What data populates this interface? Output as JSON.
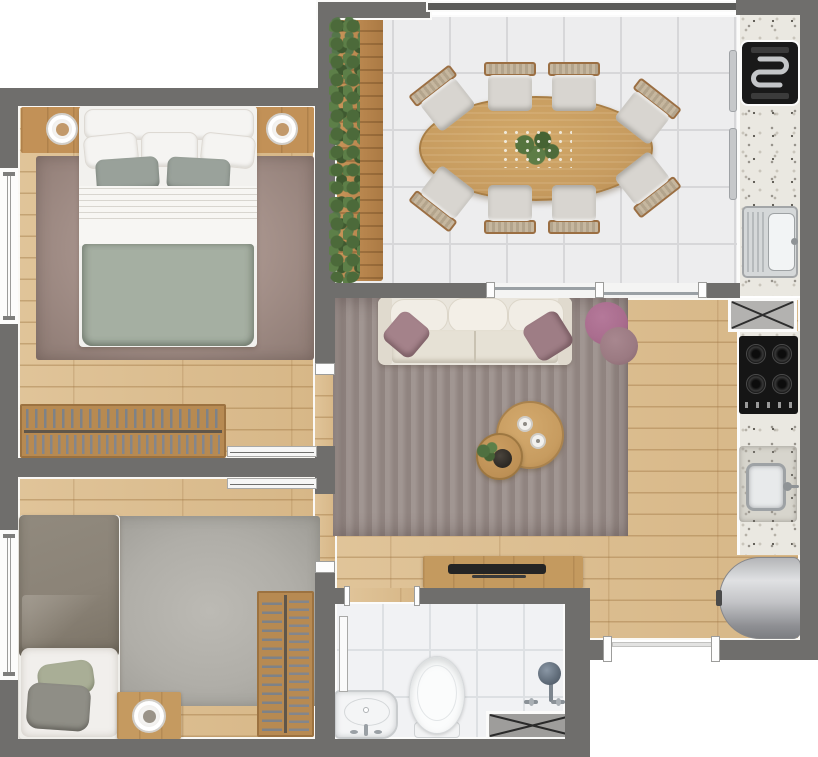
{
  "meta": {
    "type": "floor-plan",
    "render_style": "top-down 3D architectural render",
    "canvas": {
      "width": 818,
      "height": 757
    },
    "visible_text": "none"
  },
  "palette": {
    "wall": "#6f6e6c",
    "outline_white": "#fbfbfa",
    "wood_floor": "#ddc095",
    "plank_line": "#9c723e",
    "deck_wood": "#bd8a52",
    "tile_floor": "#ededee",
    "bathroom_tile": "#f1f2f4",
    "granite_counter": "#eae8e1",
    "rug_living": "#968a86",
    "rug_bedroom1": "#a5918a",
    "rug_bedroom2": "#b2b0ab",
    "sofa_cream": "#eae6dd",
    "accent_mauve": "#a4838a",
    "bed1_blanket_sage": "#a5afa2",
    "bed2_duvet_taupe": "#8b8377",
    "table_wood": "#c79c60",
    "appliance_black": "#1a1a1a",
    "stainless_steel": "#cdd0d2",
    "water_heater_gray": "#a7a8ab",
    "plant_green": "#57764a"
  },
  "rooms": [
    {
      "id": "balcony-gourmet-dining",
      "floor": "white-tile",
      "features": [
        "vertical-garden-planter",
        "wood-deck-strip",
        "glass-railing",
        "granite-counter"
      ],
      "furniture": {
        "oval_dining_table": 1,
        "plant_centerpiece": 1,
        "dining_chairs": 8,
        "electric_grill": 1,
        "counter_sink": 1
      }
    },
    {
      "id": "kitchen",
      "floor": "wood-plank",
      "features": [
        "granite-counter",
        "service-shaft"
      ],
      "furniture": {
        "cooktop_burners": 4,
        "kitchen_sink": 1,
        "water_heater_cylinder": 1
      }
    },
    {
      "id": "living-room",
      "floor": "wood-plank",
      "features": [
        "area-rug",
        "sliding-glass-door-to-balcony",
        "entry-door-opening"
      ],
      "furniture": {
        "sofa_seats": 3,
        "accent_pillows": 2,
        "poufs": 2,
        "round_coffee_tables": 2,
        "decor_plates": 2,
        "decor_bowl": 1,
        "decor_plant": 1,
        "tv_sideboard": 1,
        "tv": 1
      }
    },
    {
      "id": "bedroom-1",
      "floor": "wood-plank",
      "features": [
        "window",
        "pocket-sliding-door",
        "area-rug"
      ],
      "furniture": {
        "double_bed": 1,
        "headboard_shelf": 1,
        "table_lamps": 2,
        "clothes_rack": 1
      }
    },
    {
      "id": "bedroom-2",
      "floor": "wood-plank",
      "features": [
        "window",
        "pocket-sliding-door",
        "area-rug"
      ],
      "furniture": {
        "single_bed": 1,
        "nightstand": 1,
        "table_lamp": 1,
        "clothes_rack": 1
      }
    },
    {
      "id": "bathroom",
      "floor": "white-tile",
      "features": [
        "service-shaft",
        "sliding-door"
      ],
      "furniture": {
        "washbasin": 1,
        "toilet": 1,
        "shower_head": 1,
        "shower_handles": 2
      }
    }
  ],
  "openings": {
    "windows": 2,
    "pocket_doors": 2,
    "bathroom_door": 1,
    "glass_sliding_door": 1,
    "entry_door": 1
  }
}
